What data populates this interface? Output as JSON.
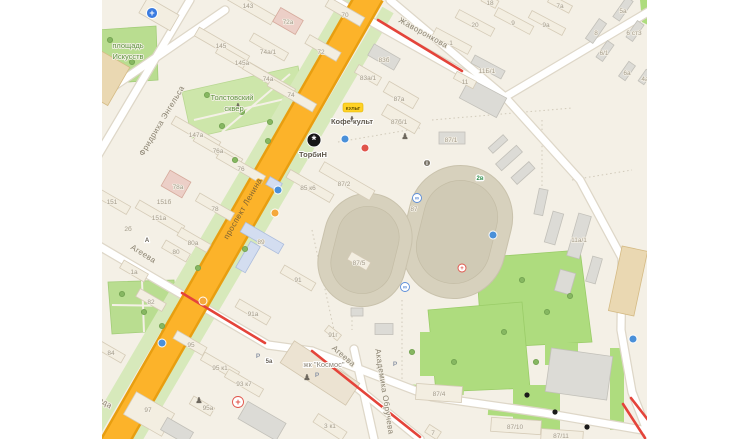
{
  "app": {
    "view": "city-map-fragment"
  },
  "colors": {
    "background": "#f4f0e6",
    "main_road": "#fcb32a",
    "main_road_casing": "#e89e10",
    "park_bright": "#aedc7e",
    "park_light": "#cde6aa",
    "traffic_jam": "#e4443a",
    "building_light": "#f3eee1",
    "building_gray": "#dcdbd6",
    "stadium_track": "#d7d1bd"
  },
  "badge": {
    "kult": "КУЛЬТ"
  },
  "traffic": {
    "color": "#e4443a",
    "segments": [
      {
        "points": [
          [
            276,
            20
          ],
          [
            360,
            71
          ]
        ]
      },
      {
        "points": [
          [
            80,
            293
          ],
          [
            163,
            343
          ]
        ]
      },
      {
        "points": [
          [
            210,
            351
          ],
          [
            318,
            437
          ]
        ]
      },
      {
        "points": [
          [
            521,
            404
          ],
          [
            543,
            438
          ]
        ]
      },
      {
        "points": [
          [
            529,
            398
          ],
          [
            546,
            420
          ]
        ]
      }
    ]
  },
  "map_labels": [
    {
      "t": "Фридриха Энгельса",
      "x": 62,
      "y": 122,
      "r": -59,
      "c": "street",
      "n": "street-label-fridrikha-engelsa"
    },
    {
      "t": "проспект Ленина",
      "x": 143,
      "y": 210,
      "r": -60,
      "c": "street road-label",
      "n": "street-label-prospekt-lenina"
    },
    {
      "t": "Агеева",
      "x": 40,
      "y": 256,
      "r": 32,
      "c": "street",
      "n": "street-label-ageeva-west"
    },
    {
      "t": "Агеева",
      "x": 240,
      "y": 358,
      "r": 41,
      "c": "street",
      "n": "street-label-ageeva-east"
    },
    {
      "t": "Академика Обручева",
      "x": 280,
      "y": 392,
      "r": 81,
      "c": "street",
      "n": "street-label-akademika-obrucheva"
    },
    {
      "t": "Жаворонкова",
      "x": 320,
      "y": 35,
      "r": 29,
      "c": "street",
      "n": "street-label-zhavoronkova"
    },
    {
      "t": "ода",
      "x": 2,
      "y": 405,
      "r": 31,
      "c": "street",
      "n": "street-label-partial"
    },
    {
      "t": "площадь",
      "x": 26,
      "y": 48,
      "r": 0,
      "c": "green",
      "n": "park-label-ploshchad-iskusstv"
    },
    {
      "t": "Искусств",
      "x": 26,
      "y": 59,
      "r": 0,
      "c": "green",
      "n": "park-label-ploshchad-iskusstv-2"
    },
    {
      "t": "Толстовский",
      "x": 130,
      "y": 100,
      "r": 0,
      "c": "green",
      "n": "park-label-tolstovsky-skver"
    },
    {
      "t": "сквер",
      "x": 132,
      "y": 111,
      "r": 0,
      "c": "green",
      "n": "park-label-tolstovsky-skver-2"
    },
    {
      "t": "Кофе культ",
      "x": 250,
      "y": 124,
      "r": 0,
      "c": "poi",
      "n": "poi-label-kofe-kult",
      "k": true
    },
    {
      "t": "ТорбиН",
      "x": 211,
      "y": 157,
      "r": 0,
      "c": "poi",
      "n": "poi-label-torbin",
      "k": true
    },
    {
      "t": "жк \"Космос\"",
      "x": 222,
      "y": 367,
      "r": 0,
      "c": "poi gray",
      "n": "poi-label-zhk-kosmos",
      "k": true
    },
    {
      "t": "5а",
      "x": 167,
      "y": 363,
      "r": 0,
      "c": "chip",
      "n": "stop-badge-5a"
    },
    {
      "t": "2в",
      "x": 378,
      "y": 180,
      "r": 0,
      "c": "chip chip-green",
      "n": "gate-badge-2v"
    },
    {
      "t": "А",
      "x": 45,
      "y": 242,
      "r": 0,
      "c": "chip",
      "n": "stop-badge-a"
    },
    {
      "t": "143",
      "x": 146,
      "y": 8
    },
    {
      "t": "72а",
      "x": 186,
      "y": 24
    },
    {
      "t": "145",
      "x": 119,
      "y": 48
    },
    {
      "t": "74а/1",
      "x": 166,
      "y": 54
    },
    {
      "t": "72",
      "x": 219,
      "y": 54
    },
    {
      "t": "145а",
      "x": 140,
      "y": 65
    },
    {
      "t": "74а",
      "x": 166,
      "y": 81
    },
    {
      "t": "74",
      "x": 189,
      "y": 97
    },
    {
      "t": "70",
      "x": 243,
      "y": 17
    },
    {
      "t": "147а",
      "x": 94,
      "y": 137
    },
    {
      "t": "76а",
      "x": 116,
      "y": 153
    },
    {
      "t": "76",
      "x": 139,
      "y": 171
    },
    {
      "t": "78а",
      "x": 76,
      "y": 189
    },
    {
      "t": "151",
      "x": 10,
      "y": 204
    },
    {
      "t": "151б",
      "x": 62,
      "y": 204
    },
    {
      "t": "78",
      "x": 113,
      "y": 211
    },
    {
      "t": "151а",
      "x": 57,
      "y": 220
    },
    {
      "t": "2б",
      "x": 26,
      "y": 231
    },
    {
      "t": "80а",
      "x": 91,
      "y": 245
    },
    {
      "t": "80",
      "x": 74,
      "y": 254
    },
    {
      "t": "1а",
      "x": 32,
      "y": 274
    },
    {
      "t": "82",
      "x": 49,
      "y": 304
    },
    {
      "t": "84",
      "x": 9,
      "y": 355
    },
    {
      "t": "89",
      "x": 159,
      "y": 244
    },
    {
      "t": "91",
      "x": 196,
      "y": 282
    },
    {
      "t": "91а",
      "x": 151,
      "y": 316
    },
    {
      "t": "91г",
      "x": 231,
      "y": 337
    },
    {
      "t": "95",
      "x": 89,
      "y": 347
    },
    {
      "t": "95 к1",
      "x": 118,
      "y": 370
    },
    {
      "t": "93 к7",
      "x": 142,
      "y": 386
    },
    {
      "t": "95а",
      "x": 106,
      "y": 410
    },
    {
      "t": "97",
      "x": 46,
      "y": 412
    },
    {
      "t": "3 к1",
      "x": 228,
      "y": 428
    },
    {
      "t": "83б",
      "x": 282,
      "y": 62
    },
    {
      "t": "83а/1",
      "x": 266,
      "y": 80
    },
    {
      "t": "87а",
      "x": 297,
      "y": 101
    },
    {
      "t": "18",
      "x": 388,
      "y": 5
    },
    {
      "t": "20",
      "x": 373,
      "y": 27
    },
    {
      "t": "1",
      "x": 349,
      "y": 45
    },
    {
      "t": "9",
      "x": 411,
      "y": 25
    },
    {
      "t": "7а",
      "x": 458,
      "y": 8
    },
    {
      "t": "9а",
      "x": 444,
      "y": 27
    },
    {
      "t": "8",
      "x": 494,
      "y": 35
    },
    {
      "t": "5а",
      "x": 521,
      "y": 13
    },
    {
      "t": "6 ст3",
      "x": 532,
      "y": 35
    },
    {
      "t": "6/1",
      "x": 502,
      "y": 55
    },
    {
      "t": "6а",
      "x": 525,
      "y": 75
    },
    {
      "t": "4а",
      "x": 543,
      "y": 81
    },
    {
      "t": "11Б/1",
      "x": 385,
      "y": 73
    },
    {
      "t": "11",
      "x": 363,
      "y": 84
    },
    {
      "t": "87б/1",
      "x": 297,
      "y": 124
    },
    {
      "t": "87/1",
      "x": 349,
      "y": 142
    },
    {
      "t": "85 к6",
      "x": 206,
      "y": 190
    },
    {
      "t": "87/2",
      "x": 242,
      "y": 186
    },
    {
      "t": "87",
      "x": 312,
      "y": 211
    },
    {
      "t": "87/5",
      "x": 257,
      "y": 265
    },
    {
      "t": "87/4",
      "x": 337,
      "y": 396
    },
    {
      "t": "87/10",
      "x": 413,
      "y": 429
    },
    {
      "t": "87/11",
      "x": 459,
      "y": 438
    },
    {
      "t": "11а/1",
      "x": 477,
      "y": 242
    },
    {
      "t": "7",
      "x": 331,
      "y": 435
    }
  ],
  "icons": [
    {
      "n": "medical-cross-icon",
      "x": 50,
      "y": 13,
      "rr": 5.5,
      "bg": "#3a7be0",
      "st": "#fff",
      "g": "+",
      "fs": 9,
      "fg": "#fff",
      "dy": 3
    },
    {
      "n": "pharmacy-cross-icon",
      "x": 136,
      "y": 402,
      "rr": 5.5,
      "bg": "#fff",
      "st": "#e0544a",
      "g": "+",
      "fs": 9,
      "fg": "#e0544a",
      "dy": 3
    },
    {
      "n": "torbin-logo-icon",
      "x": 212,
      "y": 140,
      "rr": 7,
      "bg": "#161616",
      "st": "#fff",
      "g": "*",
      "fs": 12,
      "fg": "#fff",
      "dy": 4,
      "k": true
    },
    {
      "n": "transit-stop-icon",
      "x": 176,
      "y": 190,
      "rr": 4,
      "bg": "#4a90d9",
      "st": "#fff"
    },
    {
      "n": "transit-stop-icon",
      "x": 243,
      "y": 139,
      "rr": 4,
      "bg": "#4a90d9",
      "st": "#fff"
    },
    {
      "n": "transit-stop-icon",
      "x": 60,
      "y": 343,
      "rr": 4,
      "bg": "#4a90d9",
      "st": "#fff"
    },
    {
      "n": "transit-stop-icon",
      "x": 531,
      "y": 339,
      "rr": 4,
      "bg": "#4a90d9",
      "st": "#fff"
    },
    {
      "n": "monument-icon",
      "x": 136,
      "y": 106,
      "g": "♟",
      "fs": 8,
      "fg": "#6d675d",
      "dy": 3
    },
    {
      "n": "monument-icon",
      "x": 250,
      "y": 119,
      "g": "♟",
      "fs": 8,
      "fg": "#6d675d",
      "dy": 3
    },
    {
      "n": "monument-icon",
      "x": 303,
      "y": 136,
      "g": "♟",
      "fs": 8,
      "fg": "#6d675d",
      "dy": 3
    },
    {
      "n": "monument-icon",
      "x": 205,
      "y": 377,
      "g": "♟",
      "fs": 8,
      "fg": "#6d675d",
      "dy": 3
    },
    {
      "n": "monument-icon",
      "x": 97,
      "y": 400,
      "g": "♟",
      "fs": 8,
      "fg": "#6d675d",
      "dy": 3
    },
    {
      "n": "parking-icon",
      "x": 156,
      "y": 356,
      "g": "P",
      "fs": 6.5,
      "fg": "#8d96a6",
      "dy": 2
    },
    {
      "n": "parking-icon",
      "x": 215,
      "y": 375,
      "g": "P",
      "fs": 6.5,
      "fg": "#8d96a6",
      "dy": 2
    },
    {
      "n": "parking-icon",
      "x": 293,
      "y": 364,
      "g": "P",
      "fs": 6.5,
      "fg": "#8d96a6",
      "dy": 2
    },
    {
      "n": "bike-icon",
      "x": 315,
      "y": 198,
      "rr": 4.5,
      "bg": "#fff",
      "st": "#5b8dd9",
      "g": "∞",
      "fs": 6,
      "fg": "#5b8dd9",
      "dy": 2
    },
    {
      "n": "bike-icon",
      "x": 303,
      "y": 287,
      "rr": 4.5,
      "bg": "#fff",
      "st": "#5b8dd9",
      "g": "∞",
      "fs": 6,
      "fg": "#5b8dd9",
      "dy": 2
    },
    {
      "n": "info-icon",
      "x": 325,
      "y": 163,
      "rr": 3.5,
      "bg": "#7a7468",
      "st": "#fff",
      "g": "i",
      "fs": 6,
      "fg": "#fff",
      "dy": 2
    },
    {
      "n": "entrance-number-icon",
      "x": 425,
      "y": 395,
      "rr": 2.6,
      "bg": "#1a1a1a"
    },
    {
      "n": "entrance-number-icon",
      "x": 453,
      "y": 412,
      "rr": 2.6,
      "bg": "#1a1a1a"
    },
    {
      "n": "entrance-number-icon",
      "x": 485,
      "y": 427,
      "rr": 2.6,
      "bg": "#1a1a1a"
    },
    {
      "n": "shop-poi-icon",
      "x": 173,
      "y": 213,
      "rr": 4,
      "bg": "#f5a83c",
      "st": "#fff"
    },
    {
      "n": "shop-poi-icon",
      "x": 101,
      "y": 301,
      "rr": 4,
      "bg": "#f5a83c",
      "st": "#fff"
    },
    {
      "n": "cafe-poi-icon",
      "x": 263,
      "y": 148,
      "rr": 4,
      "bg": "#e0544a",
      "st": "#fff"
    },
    {
      "n": "first-aid-icon",
      "x": 360,
      "y": 268,
      "rr": 4,
      "bg": "#fff",
      "st": "#e0544a",
      "g": "+",
      "fs": 6,
      "fg": "#e0544a",
      "dy": 2
    },
    {
      "n": "ticket-poi-icon",
      "x": 391,
      "y": 235,
      "rr": 4,
      "bg": "#4a90d9",
      "st": "#fff"
    },
    {
      "n": "tree-icon",
      "x": 8,
      "y": 40,
      "rr": 2.6,
      "bg": "#86b761",
      "st": "#74a452"
    },
    {
      "n": "tree-icon",
      "x": 30,
      "y": 62,
      "rr": 2.6,
      "bg": "#86b761",
      "st": "#74a452"
    },
    {
      "n": "tree-icon",
      "x": 105,
      "y": 95,
      "rr": 2.6,
      "bg": "#86b761",
      "st": "#74a452"
    },
    {
      "n": "tree-icon",
      "x": 140,
      "y": 112,
      "rr": 2.6,
      "bg": "#86b761",
      "st": "#74a452"
    },
    {
      "n": "tree-icon",
      "x": 168,
      "y": 122,
      "rr": 2.6,
      "bg": "#86b761",
      "st": "#74a452"
    },
    {
      "n": "tree-icon",
      "x": 120,
      "y": 126,
      "rr": 2.6,
      "bg": "#86b761",
      "st": "#74a452"
    },
    {
      "n": "tree-icon",
      "x": 20,
      "y": 294,
      "rr": 2.6,
      "bg": "#86b761",
      "st": "#74a452"
    },
    {
      "n": "tree-icon",
      "x": 42,
      "y": 312,
      "rr": 2.6,
      "bg": "#86b761",
      "st": "#74a452"
    },
    {
      "n": "tree-icon",
      "x": 60,
      "y": 326,
      "rr": 2.6,
      "bg": "#86b761",
      "st": "#74a452"
    },
    {
      "n": "tree-icon",
      "x": 420,
      "y": 280,
      "rr": 2.6,
      "bg": "#86b761",
      "st": "#74a452"
    },
    {
      "n": "tree-icon",
      "x": 445,
      "y": 312,
      "rr": 2.6,
      "bg": "#86b761",
      "st": "#74a452"
    },
    {
      "n": "tree-icon",
      "x": 402,
      "y": 332,
      "rr": 2.6,
      "bg": "#86b761",
      "st": "#74a452"
    },
    {
      "n": "tree-icon",
      "x": 352,
      "y": 362,
      "rr": 2.6,
      "bg": "#86b761",
      "st": "#74a452"
    },
    {
      "n": "tree-icon",
      "x": 434,
      "y": 362,
      "rr": 2.6,
      "bg": "#86b761",
      "st": "#74a452"
    },
    {
      "n": "tree-icon",
      "x": 468,
      "y": 296,
      "rr": 2.6,
      "bg": "#86b761",
      "st": "#74a452"
    },
    {
      "n": "tree-icon",
      "x": 310,
      "y": 352,
      "rr": 2.6,
      "bg": "#86b761",
      "st": "#74a452"
    },
    {
      "n": "tree-icon",
      "x": 166,
      "y": 141,
      "rr": 2.6,
      "bg": "#86b761",
      "st": "#74a452"
    },
    {
      "n": "tree-icon",
      "x": 143,
      "y": 249,
      "rr": 2.6,
      "bg": "#86b761",
      "st": "#74a452"
    },
    {
      "n": "tree-icon",
      "x": 96,
      "y": 268,
      "rr": 2.6,
      "bg": "#86b761",
      "st": "#74a452"
    },
    {
      "n": "tree-icon",
      "x": 133,
      "y": 160,
      "rr": 2.6,
      "bg": "#86b761",
      "st": "#74a452"
    }
  ]
}
